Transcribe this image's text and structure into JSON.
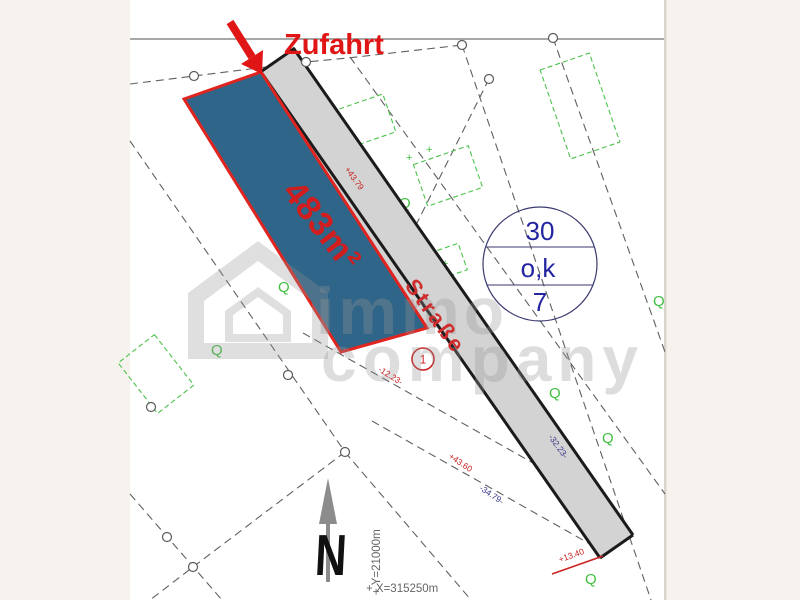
{
  "labels": {
    "access": "Zufahrt",
    "area": "483m²",
    "street": "Straße",
    "parcel_number": "1",
    "parcel_type": "Q",
    "north": "N",
    "coord_y": "+ Y=21000m",
    "coord_x": "+ X=315250m"
  },
  "badge": {
    "line1": "30",
    "line2": "o,k",
    "line3": "7"
  },
  "measurements": {
    "m1": "-12.23-",
    "m2": "+43.60",
    "m3": "-34.79-",
    "m4": "-32.23-",
    "m5": "+13.40",
    "m6": "+43.79"
  },
  "watermark": {
    "line1": "immo",
    "line2": "company"
  },
  "colors": {
    "background": "#f6f3ee",
    "paper": "#ffffff",
    "plot_fill": "#2f6588",
    "plot_border": "#e02420",
    "highlight_red": "#e01616",
    "street_fill": "#d3d3d3",
    "street_edge": "#1b1b1b",
    "navy_text": "#2424a0",
    "green": "#3fbf3f",
    "watermark_gray": "#dcdcdc"
  }
}
